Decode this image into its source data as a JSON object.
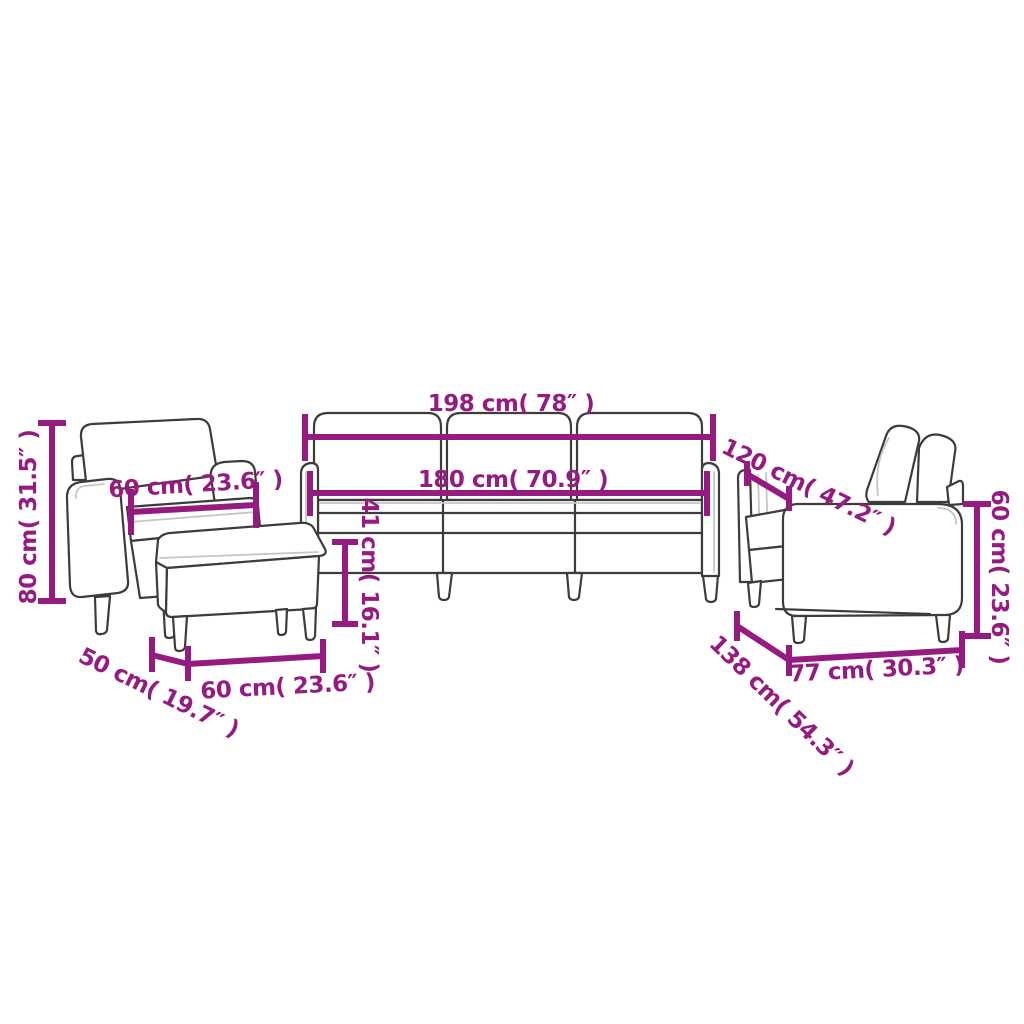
{
  "canvas": {
    "background": "#ffffff",
    "accent_color": "#951b81",
    "line_color": "#3d3c3b"
  },
  "pieces": [
    {
      "id": "armchair",
      "dimension_ids": [
        "armchair_height",
        "armchair_seat_width"
      ]
    },
    {
      "id": "footstool",
      "dimension_ids": [
        "ottoman_depth",
        "ottoman_width"
      ]
    },
    {
      "id": "three_seater_sofa",
      "dimension_ids": [
        "sofa3_width",
        "sofa3_inner_width",
        "sofa3_depth",
        "seat_height"
      ]
    },
    {
      "id": "two_seater_sofa",
      "dimension_ids": [
        "sofa2_length",
        "sofa2_depth",
        "sofa2_height"
      ]
    }
  ],
  "dimensions": {
    "sofa3_width": {
      "cm": "198",
      "inch": "78",
      "label": "198 cm( 78″ )"
    },
    "sofa3_inner_width": {
      "cm": "180",
      "inch": "70.9",
      "label": "180 cm( 70.9″ )"
    },
    "sofa3_depth": {
      "cm": "120",
      "inch": "47.2",
      "label": "120 cm( 47.2″ )"
    },
    "armchair_height": {
      "cm": "80",
      "inch": "31.5",
      "label": "80 cm( 31.5″ )"
    },
    "armchair_seat_width": {
      "cm": "60",
      "inch": "23.6",
      "label": "60 cm( 23.6″ )"
    },
    "seat_height": {
      "cm": "41",
      "inch": "16.1",
      "label": "41 cm( 16.1″ )"
    },
    "ottoman_depth": {
      "cm": "50",
      "inch": "19.7",
      "label": "50 cm( 19.7″ )"
    },
    "ottoman_width": {
      "cm": "60",
      "inch": "23.6",
      "label": "60 cm( 23.6″ )"
    },
    "sofa2_length": {
      "cm": "138",
      "inch": "54.3",
      "label": "138 cm( 54.3″ )"
    },
    "sofa2_depth": {
      "cm": "77",
      "inch": "30.3",
      "label": "77 cm( 30.3″ )"
    },
    "sofa2_height": {
      "cm": "60",
      "inch": "23.6",
      "label": "60 cm( 23.6″ )"
    }
  }
}
